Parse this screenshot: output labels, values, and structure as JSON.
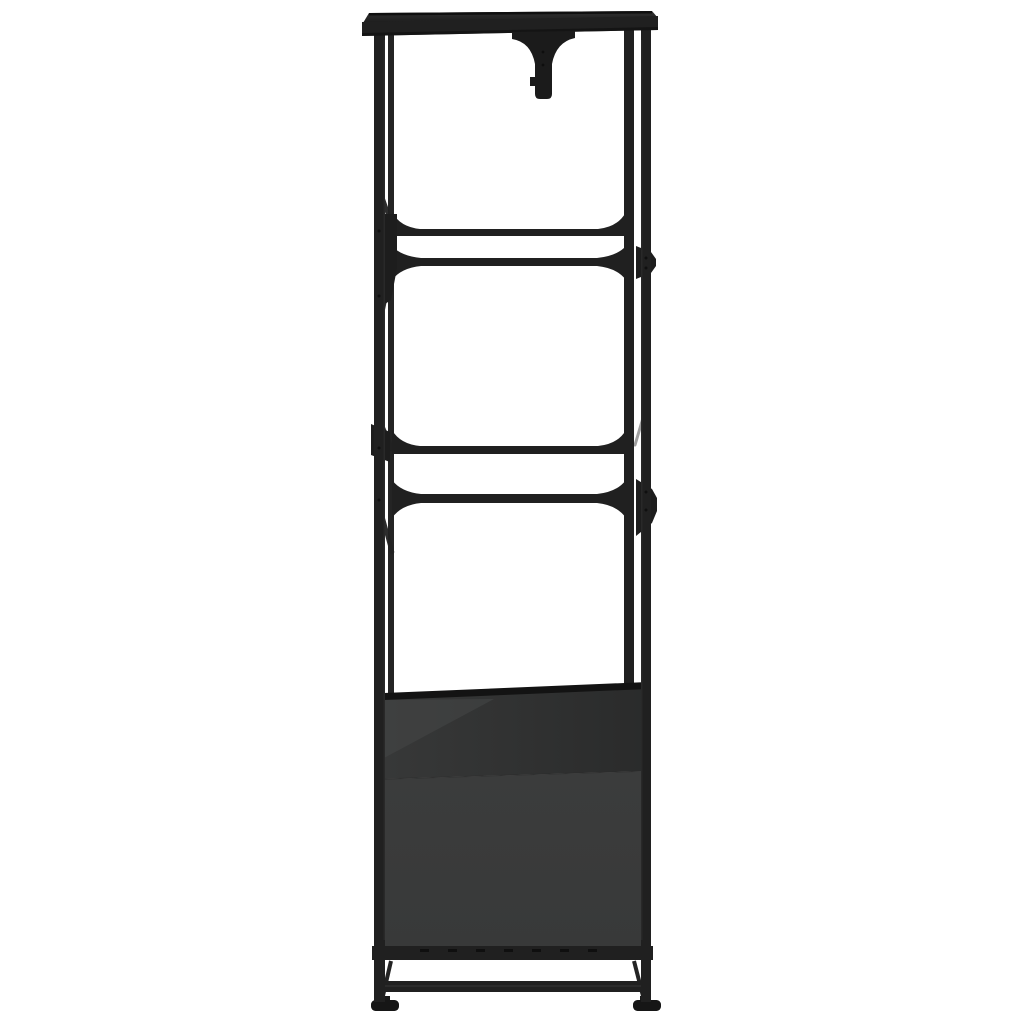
{
  "page": {
    "background": "#ffffff"
  },
  "product_photo": {
    "description": "Black steel open wardrobe frame with hanging-rail bracket, two shelf levels and a dark grey storage cabinet base, narrow side view on white background",
    "colors": {
      "frame": "#202020",
      "frame_dark": "#131313",
      "frame_edge_highlight": "#3d3d3d",
      "bracket": "#1b1b1b",
      "panel_upper_left": "#373838",
      "panel_upper_right": "#2a2b2b",
      "panel_lower": "#3b3c3c",
      "panel_lower_deep": "#383939",
      "panel_highlight": "#464747",
      "seam": "#2a2a2a",
      "foot": "#161616",
      "screw_dot": "#0b0b0b",
      "background": "#ffffff"
    }
  }
}
